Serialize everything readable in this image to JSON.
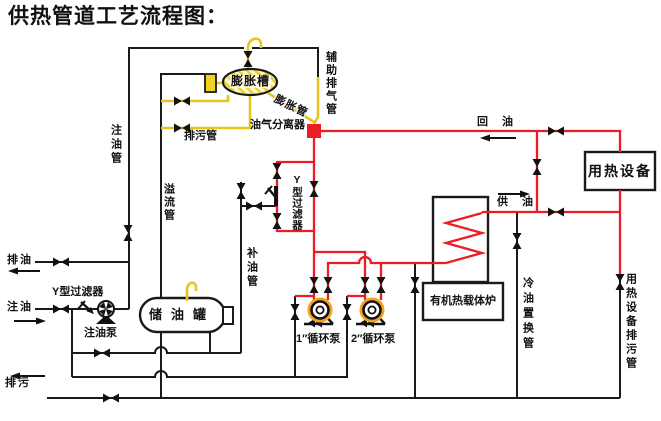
{
  "title": "供热管道工艺流程图：",
  "colors": {
    "pipe_red": "#ed1c24",
    "pipe_yellow": "#e9c41e",
    "line_black": "#1a1a1a",
    "hatch_bg": "#fbf6d2"
  },
  "labels": {
    "expansion_tank": "膨胀槽",
    "aux_exhaust_pipe": "辅助排气管",
    "expansion_pipe": "膨胀管",
    "separator": "油气分离器",
    "return_oil": "回油",
    "heat_equipment": "用热设备",
    "fill_pipe": "注油管",
    "blowdown_pipe": "排污管",
    "overflow_pipe": "溢流管",
    "y_filter_main": "Y型过滤器",
    "makeup_pipe": "补油管",
    "supply_oil": "供油",
    "drain_oil": "排油",
    "fill_oil": "注油",
    "y_filter_fill": "Y型过滤器",
    "fill_pump": "注油泵",
    "storage_tank": "储油罐",
    "pump1": "1″循环泵",
    "pump2": "2″循环泵",
    "furnace": "有机热载体炉",
    "cold_oil_pipe": "冷油置换管",
    "equipment_blowdown_pipe": "用热设备排污管",
    "blowdown": "排污"
  }
}
